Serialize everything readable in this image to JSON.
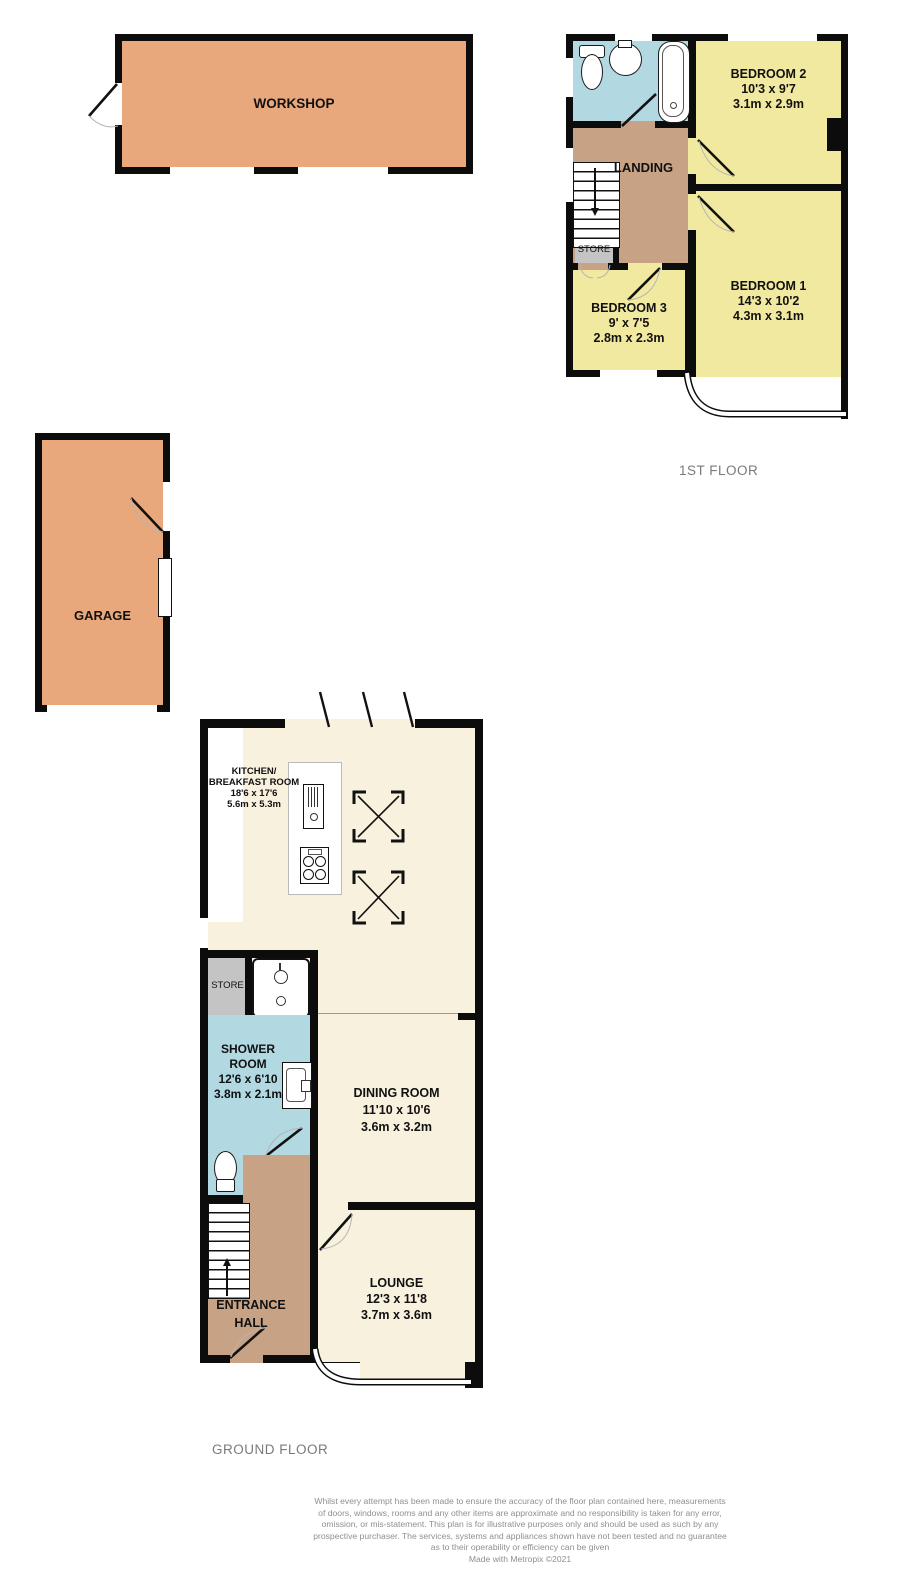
{
  "colors": {
    "wall": "#0c0c0c",
    "outbuilding_fill": "#e9a77c",
    "bedroom_fill": "#f2e9a1",
    "hall_fill": "#c8a284",
    "bathroom_fill": "#b2d8e2",
    "living_fill": "#f8f1de",
    "store_fill": "#c4c4c4",
    "floor_label_text": "#7a7a7a",
    "disclaimer_text": "#8f8f8f"
  },
  "floors": {
    "first": {
      "label": "1ST FLOOR",
      "rooms": {
        "bedroom2": {
          "name": "BEDROOM 2",
          "imperial": "10'3 x 9'7",
          "metric": "3.1m x 2.9m"
        },
        "bedroom1": {
          "name": "BEDROOM 1",
          "imperial": "14'3 x 10'2",
          "metric": "4.3m x 3.1m"
        },
        "bedroom3": {
          "name": "BEDROOM 3",
          "imperial": "9' x 7'5",
          "metric": "2.8m x 2.3m"
        },
        "landing": {
          "name": "LANDING"
        },
        "store": {
          "name": "STORE"
        }
      }
    },
    "ground": {
      "label": "GROUND FLOOR",
      "rooms": {
        "kitchen": {
          "name_line1": "KITCHEN/",
          "name_line2": "BREAKFAST ROOM",
          "imperial": "18'6 x 17'6",
          "metric": "5.6m x 5.3m"
        },
        "shower": {
          "name_line1": "SHOWER",
          "name_line2": "ROOM",
          "imperial": "12'6 x 6'10",
          "metric": "3.8m x 2.1m"
        },
        "dining": {
          "name": "DINING ROOM",
          "imperial": "11'10 x 10'6",
          "metric": "3.6m x 3.2m"
        },
        "lounge": {
          "name": "LOUNGE",
          "imperial": "12'3 x 11'8",
          "metric": "3.7m x 3.6m"
        },
        "hall": {
          "name_line1": "ENTRANCE",
          "name_line2": "HALL"
        },
        "store": {
          "name": "STORE"
        }
      }
    },
    "outbuildings": {
      "workshop": {
        "name": "WORKSHOP"
      },
      "garage": {
        "name": "GARAGE"
      }
    }
  },
  "fixtures": [
    "toilet-icon",
    "pedestal-sink-icon",
    "bathtub-icon",
    "shower-tray-icon",
    "wash-basin-icon",
    "fridge-icon",
    "hob-icon",
    "stairs",
    "skylight-symbol",
    "door-swing"
  ],
  "disclaimer": {
    "lines": [
      "Whilst every attempt has been made to ensure the accuracy of the floor plan contained here, measurements",
      "of doors, windows, rooms and any other items are approximate and no responsibility is taken for any error,",
      "omission, or mis-statement. This plan is for illustrative purposes only and should be used as such by any",
      "prospective purchaser. The services, systems and appliances shown have not been tested and no guarantee",
      "as to their operability or efficiency can be given",
      "Made with Metropix ©2021"
    ]
  }
}
